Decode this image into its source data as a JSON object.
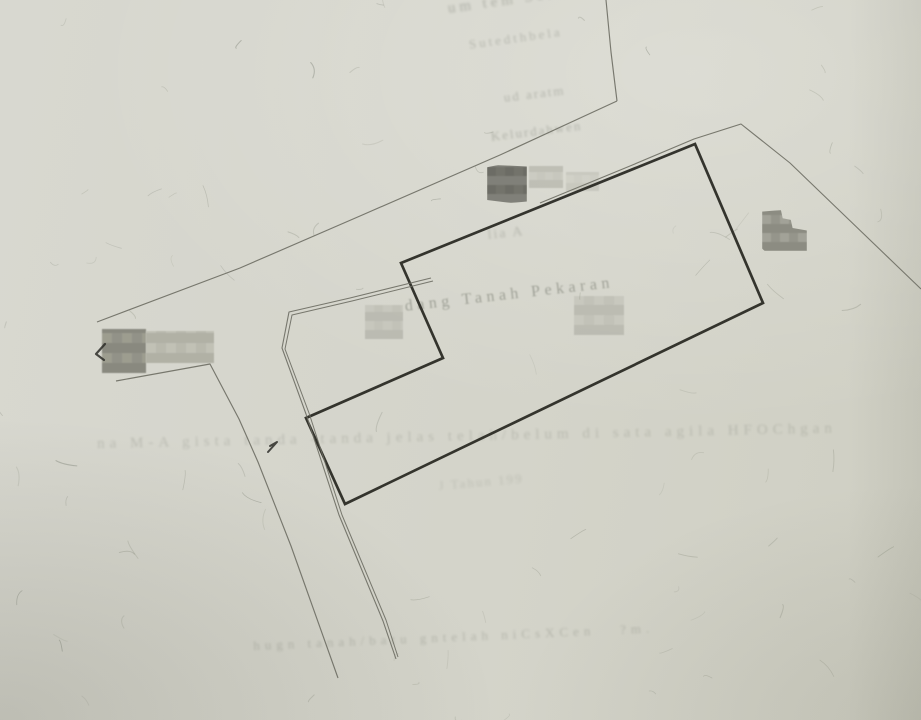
{
  "paper": {
    "base_color": "#d4d4ca"
  },
  "faint_texts": [
    {
      "text": "um tem Selande",
      "x": 447,
      "y": 2,
      "size": 15,
      "rot": -8,
      "op": 0.3,
      "blur": 1.2,
      "ls": 4
    },
    {
      "text": "Sutedthbela",
      "x": 468,
      "y": 38,
      "size": 13,
      "rot": -8,
      "op": 0.24,
      "blur": 1.1,
      "ls": 3
    },
    {
      "text": "ud aratm",
      "x": 503,
      "y": 91,
      "size": 13,
      "rot": -7,
      "op": 0.26,
      "blur": 1.0,
      "ls": 2
    },
    {
      "text": "Kelurdahwen",
      "x": 490,
      "y": 130,
      "size": 13,
      "rot": -7,
      "op": 0.27,
      "blur": 1.0,
      "ls": 2
    },
    {
      "text": "lia A",
      "x": 487,
      "y": 229,
      "size": 14,
      "rot": -6,
      "op": 0.22,
      "blur": 1.0,
      "ls": 2
    },
    {
      "text": "dang Tanah Pekaran",
      "x": 404,
      "y": 299,
      "size": 16,
      "rot": -6.5,
      "op": 0.38,
      "blur": 0.8,
      "ls": 4.5
    },
    {
      "text": "na M-A gista tanda -tanda jelas telah/belum di sata agila HFOChgan",
      "x": 97,
      "y": 437,
      "size": 15,
      "rot": -1.2,
      "op": 0.18,
      "blur": 1.1,
      "ls": 5
    },
    {
      "text": "J Tahun 199",
      "x": 438,
      "y": 479,
      "size": 13,
      "rot": -5,
      "op": 0.15,
      "blur": 1.2,
      "ls": 2
    },
    {
      "text": "hugn tanah/batu gntelah niCsXCen   ?m.",
      "x": 253,
      "y": 639,
      "size": 13,
      "rot": -2.5,
      "op": 0.21,
      "blur": 1.0,
      "ls": 5
    }
  ],
  "redactions": [
    {
      "name": "redaction-dark-upper",
      "x": 487,
      "y": 165,
      "w": 40,
      "h": 38,
      "c1": "#6e6e66",
      "c2": "#7c7c74",
      "c3": "#67675f",
      "cell": 9,
      "op": 0.95,
      "clip": "polygon(0% 6%, 28% 0%, 100% 4%, 100% 96%, 60% 100%, 0% 92%)"
    },
    {
      "name": "redaction-blur-upper-mid",
      "x": 529,
      "y": 166,
      "w": 34,
      "h": 22,
      "c1": "#c0c0b6",
      "c2": "#b4b4aa",
      "c3": "#c6c6bc",
      "cell": 8,
      "op": 0.7,
      "clip": ""
    },
    {
      "name": "redaction-blur-upper-right",
      "x": 566,
      "y": 172,
      "w": 33,
      "h": 19,
      "c1": "#c4c4ba",
      "c2": "#bcbcb2",
      "c3": "#cacac0",
      "cell": 8,
      "op": 0.55,
      "clip": ""
    },
    {
      "name": "redaction-right",
      "x": 762,
      "y": 210,
      "w": 45,
      "h": 41,
      "c1": "#909086",
      "c2": "#86867c",
      "c3": "#9e9e94",
      "cell": 9,
      "op": 0.92,
      "clip": "polygon(0% 4%, 42% 0%, 46% 20%, 64% 24%, 68% 44%, 100% 50%, 100% 100%, 6% 100%, 0% 94%)"
    },
    {
      "name": "redaction-left-label-dark",
      "x": 102,
      "y": 329,
      "w": 44,
      "h": 44,
      "c1": "#8b8b81",
      "c2": "#818177",
      "c3": "#979789",
      "cell": 10,
      "op": 0.9,
      "clip": ""
    },
    {
      "name": "redaction-left-label-light",
      "x": 146,
      "y": 331,
      "w": 68,
      "h": 32,
      "c1": "#b2b2a6",
      "c2": "#a8a89c",
      "c3": "#bcbcb0",
      "cell": 10,
      "op": 0.8,
      "clip": ""
    },
    {
      "name": "redaction-mid-left",
      "x": 365,
      "y": 305,
      "w": 38,
      "h": 34,
      "c1": "#b8b8ae",
      "c2": "#aeaea4",
      "c3": "#c0c0b6",
      "cell": 9,
      "op": 0.65,
      "clip": ""
    },
    {
      "name": "redaction-mid-right",
      "x": 574,
      "y": 296,
      "w": 50,
      "h": 39,
      "c1": "#b5b5ab",
      "c2": "#ababa1",
      "c3": "#bfbfb5",
      "cell": 10,
      "op": 0.6,
      "clip": ""
    }
  ],
  "sketch": {
    "thick_color": "#26261f",
    "thin_color": "#6d6d63",
    "parcel_boundary": {
      "points": [
        [
          401,
          263
        ],
        [
          695,
          144
        ],
        [
          763,
          303
        ],
        [
          345,
          504
        ],
        [
          306,
          418
        ],
        [
          443,
          358
        ]
      ],
      "width": 2.7
    },
    "thin_lines": [
      {
        "name": "road-upper-edge-top",
        "pts": [
          [
            606,
            0
          ],
          [
            611,
            52
          ],
          [
            617,
            101
          ]
        ],
        "w": 1.15
      },
      {
        "name": "road-upper-edge",
        "pts": [
          [
            617,
            101
          ],
          [
            500,
            155
          ],
          [
            360,
            216
          ],
          [
            240,
            268
          ],
          [
            97,
            322
          ]
        ],
        "w": 1.15
      },
      {
        "name": "road-right-edge-outer",
        "pts": [
          [
            431,
            278
          ],
          [
            350,
            298
          ],
          [
            289,
            312
          ],
          [
            282,
            348
          ],
          [
            306,
            414
          ],
          [
            339,
            515
          ],
          [
            383,
            621
          ],
          [
            396,
            659
          ]
        ],
        "w": 1.1
      },
      {
        "name": "road-right-edge-inner",
        "pts": [
          [
            433,
            281
          ],
          [
            352,
            301
          ],
          [
            292,
            315
          ],
          [
            285,
            349
          ],
          [
            309,
            413
          ],
          [
            342,
            515
          ],
          [
            386,
            620
          ],
          [
            398,
            657
          ]
        ],
        "w": 1.0
      },
      {
        "name": "road-left-edge",
        "pts": [
          [
            116,
            381
          ],
          [
            210,
            364
          ],
          [
            239,
            419
          ],
          [
            258,
            462
          ],
          [
            291,
            546
          ],
          [
            338,
            678
          ]
        ],
        "w": 1.15
      },
      {
        "name": "neighbor-boundary",
        "pts": [
          [
            540,
            203
          ],
          [
            630,
            166
          ],
          [
            694,
            139
          ],
          [
            741,
            124
          ],
          [
            790,
            163
          ],
          [
            843,
            214
          ],
          [
            921,
            289
          ]
        ],
        "w": 1.1
      }
    ],
    "marks": [
      {
        "name": "survey-tick-west",
        "pts": [
          [
            105,
            344
          ],
          [
            96,
            354
          ],
          [
            104,
            360
          ]
        ],
        "w": 2.2
      },
      {
        "name": "survey-tick-center",
        "pts": [
          [
            270,
            446
          ],
          [
            277,
            442
          ],
          [
            268,
            452
          ]
        ],
        "w": 2.0
      }
    ]
  },
  "texture": {
    "squiggles": 85,
    "color": "#767b6b",
    "dark_color": "#5a5f52"
  }
}
